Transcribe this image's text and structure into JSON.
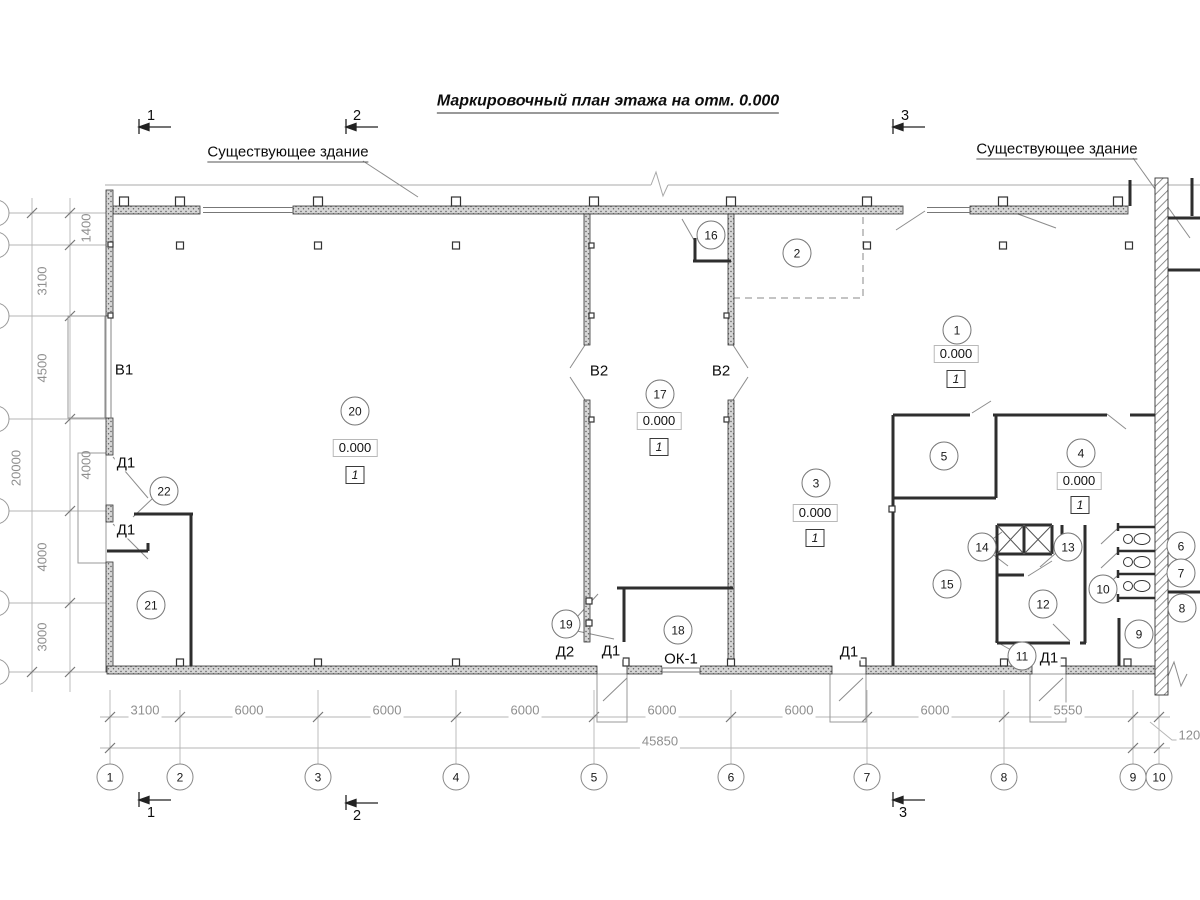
{
  "title": "Маркировочный план этажа на отм. 0.000",
  "annotations": {
    "existing_building_left": "Существующее здание",
    "existing_building_right": "Существующее здание"
  },
  "rooms": [
    {
      "n": "1",
      "x": 957,
      "y": 330
    },
    {
      "n": "2",
      "x": 797,
      "y": 253
    },
    {
      "n": "3",
      "x": 816,
      "y": 483
    },
    {
      "n": "4",
      "x": 1081,
      "y": 453
    },
    {
      "n": "5",
      "x": 944,
      "y": 456
    },
    {
      "n": "6",
      "x": 1181,
      "y": 546
    },
    {
      "n": "7",
      "x": 1181,
      "y": 573
    },
    {
      "n": "8",
      "x": 1182,
      "y": 608
    },
    {
      "n": "9",
      "x": 1139,
      "y": 634
    },
    {
      "n": "10",
      "x": 1103,
      "y": 589
    },
    {
      "n": "11",
      "x": 1022,
      "y": 656
    },
    {
      "n": "12",
      "x": 1043,
      "y": 604
    },
    {
      "n": "13",
      "x": 1068,
      "y": 547
    },
    {
      "n": "14",
      "x": 982,
      "y": 547
    },
    {
      "n": "15",
      "x": 947,
      "y": 584
    },
    {
      "n": "16",
      "x": 711,
      "y": 235
    },
    {
      "n": "17",
      "x": 660,
      "y": 394
    },
    {
      "n": "18",
      "x": 678,
      "y": 630
    },
    {
      "n": "19",
      "x": 566,
      "y": 624
    },
    {
      "n": "20",
      "x": 355,
      "y": 411
    },
    {
      "n": "21",
      "x": 151,
      "y": 605
    },
    {
      "n": "22",
      "x": 164,
      "y": 491
    }
  ],
  "elevation_marks": [
    {
      "v": "0.000",
      "x": 355,
      "y": 448
    },
    {
      "v": "0.000",
      "x": 659,
      "y": 421
    },
    {
      "v": "0.000",
      "x": 815,
      "y": 513
    },
    {
      "v": "0.000",
      "x": 956,
      "y": 354
    },
    {
      "v": "0.000",
      "x": 1079,
      "y": 481
    }
  ],
  "type_marks": [
    {
      "v": "1",
      "x": 355,
      "y": 475
    },
    {
      "v": "1",
      "x": 659,
      "y": 447
    },
    {
      "v": "1",
      "x": 815,
      "y": 538
    },
    {
      "v": "1",
      "x": 956,
      "y": 379
    },
    {
      "v": "1",
      "x": 1080,
      "y": 505
    }
  ],
  "opening_labels": [
    {
      "t": "В1",
      "x": 124,
      "y": 370
    },
    {
      "t": "В2",
      "x": 599,
      "y": 371
    },
    {
      "t": "В2",
      "x": 721,
      "y": 371
    },
    {
      "t": "Д1",
      "x": 126,
      "y": 463
    },
    {
      "t": "Д1",
      "x": 126,
      "y": 530
    },
    {
      "t": "Д2",
      "x": 565,
      "y": 652
    },
    {
      "t": "Д1",
      "x": 611,
      "y": 651
    },
    {
      "t": "ОК-1",
      "x": 681,
      "y": 659
    },
    {
      "t": "Д1",
      "x": 849,
      "y": 652
    },
    {
      "t": "Д1",
      "x": 1049,
      "y": 658
    }
  ],
  "dimensions": {
    "horizontal": [
      {
        "v": "3100",
        "x": 145
      },
      {
        "v": "6000",
        "x": 249
      },
      {
        "v": "6000",
        "x": 387
      },
      {
        "v": "6000",
        "x": 525
      },
      {
        "v": "6000",
        "x": 662
      },
      {
        "v": "6000",
        "x": 799
      },
      {
        "v": "6000",
        "x": 935
      },
      {
        "v": "5550",
        "x": 1068
      }
    ],
    "total": {
      "v": "45850",
      "x": 660,
      "y": 741
    },
    "right_extra": {
      "v": "1200",
      "x": 1193,
      "y": 735
    },
    "vertical": [
      {
        "v": "1400",
        "x": 86,
        "y": 228
      },
      {
        "v": "3100",
        "x": 42,
        "y": 281
      },
      {
        "v": "4500",
        "x": 42,
        "y": 368
      },
      {
        "v": "4000",
        "x": 86,
        "y": 465
      },
      {
        "v": "4000",
        "x": 42,
        "y": 557
      },
      {
        "v": "3000",
        "x": 42,
        "y": 637
      },
      {
        "v": "20000",
        "x": 16,
        "y": 468
      }
    ]
  },
  "grid_bubbles": [
    {
      "n": "1",
      "x": 110
    },
    {
      "n": "2",
      "x": 180
    },
    {
      "n": "3",
      "x": 318
    },
    {
      "n": "4",
      "x": 456
    },
    {
      "n": "5",
      "x": 594
    },
    {
      "n": "6",
      "x": 731
    },
    {
      "n": "7",
      "x": 867
    },
    {
      "n": "8",
      "x": 1004
    },
    {
      "n": "9",
      "x": 1133
    },
    {
      "n": "10",
      "x": 1159
    }
  ],
  "section_markers": [
    {
      "n": "1",
      "x": 151,
      "y": 116,
      "side": "top"
    },
    {
      "n": "2",
      "x": 357,
      "y": 116,
      "side": "top"
    },
    {
      "n": "3",
      "x": 905,
      "y": 116,
      "side": "top"
    },
    {
      "n": "1",
      "x": 151,
      "y": 813,
      "side": "bottom"
    },
    {
      "n": "2",
      "x": 357,
      "y": 816,
      "side": "bottom"
    },
    {
      "n": "3",
      "x": 903,
      "y": 813,
      "side": "bottom"
    }
  ]
}
